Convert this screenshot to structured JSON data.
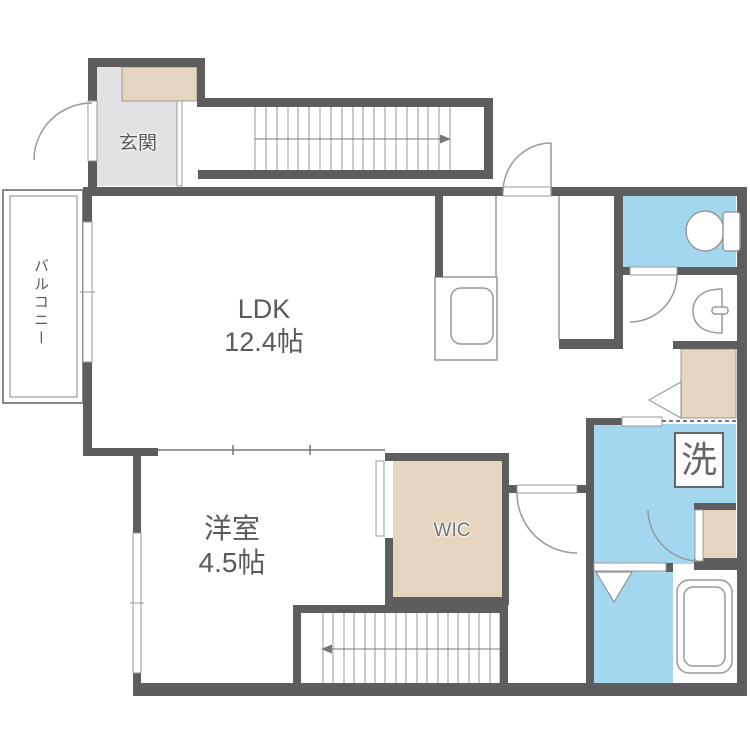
{
  "title": "1LDK floor plan",
  "rooms": {
    "ldk": {
      "name": "LDK",
      "area": "12.4帖"
    },
    "western_room": {
      "name": "洋室",
      "area": "4.5帖"
    },
    "entrance": {
      "name": "玄関"
    },
    "balcony": {
      "name": "バルコニー"
    },
    "wic": {
      "name": "WIC"
    },
    "laundry": {
      "name": "洗"
    }
  },
  "colors": {
    "wall": "#5d5d5d",
    "wet_area": "#a3d7ef",
    "storage": "#e5d4be",
    "entrance_floor": "#e2e2e4",
    "line": "#8c8c8c",
    "text": "#5a5a5a"
  }
}
